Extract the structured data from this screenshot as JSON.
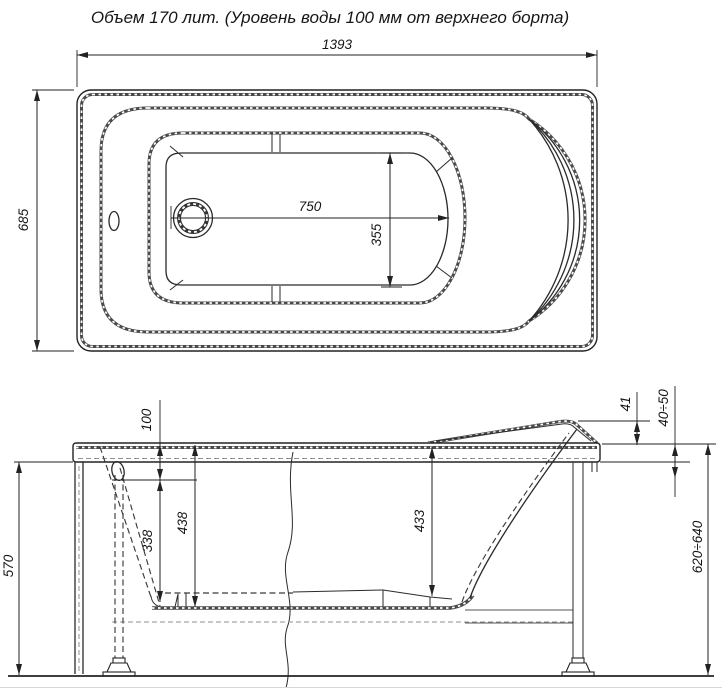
{
  "title": "Объем 170 лит. (Уровень воды 100 мм от верхнего борта)",
  "top_view": {
    "overall_length_mm": "1393",
    "overall_width_mm": "685",
    "bottom_length_mm": "750",
    "bottom_width_mm": "355"
  },
  "side_view": {
    "water_level_from_rim_mm": "100",
    "headrest_rise_mm": "41",
    "rim_band_range_mm": "40÷50",
    "apron_height_mm": "570",
    "water_to_bottom_mm": "338",
    "rim_to_bottom_mm": "438",
    "rim_to_seat_bottom_mm": "433",
    "floor_to_rim_range_mm": "620÷640"
  },
  "colors": {
    "line": "#2a2a2a",
    "background": "#ffffff"
  }
}
